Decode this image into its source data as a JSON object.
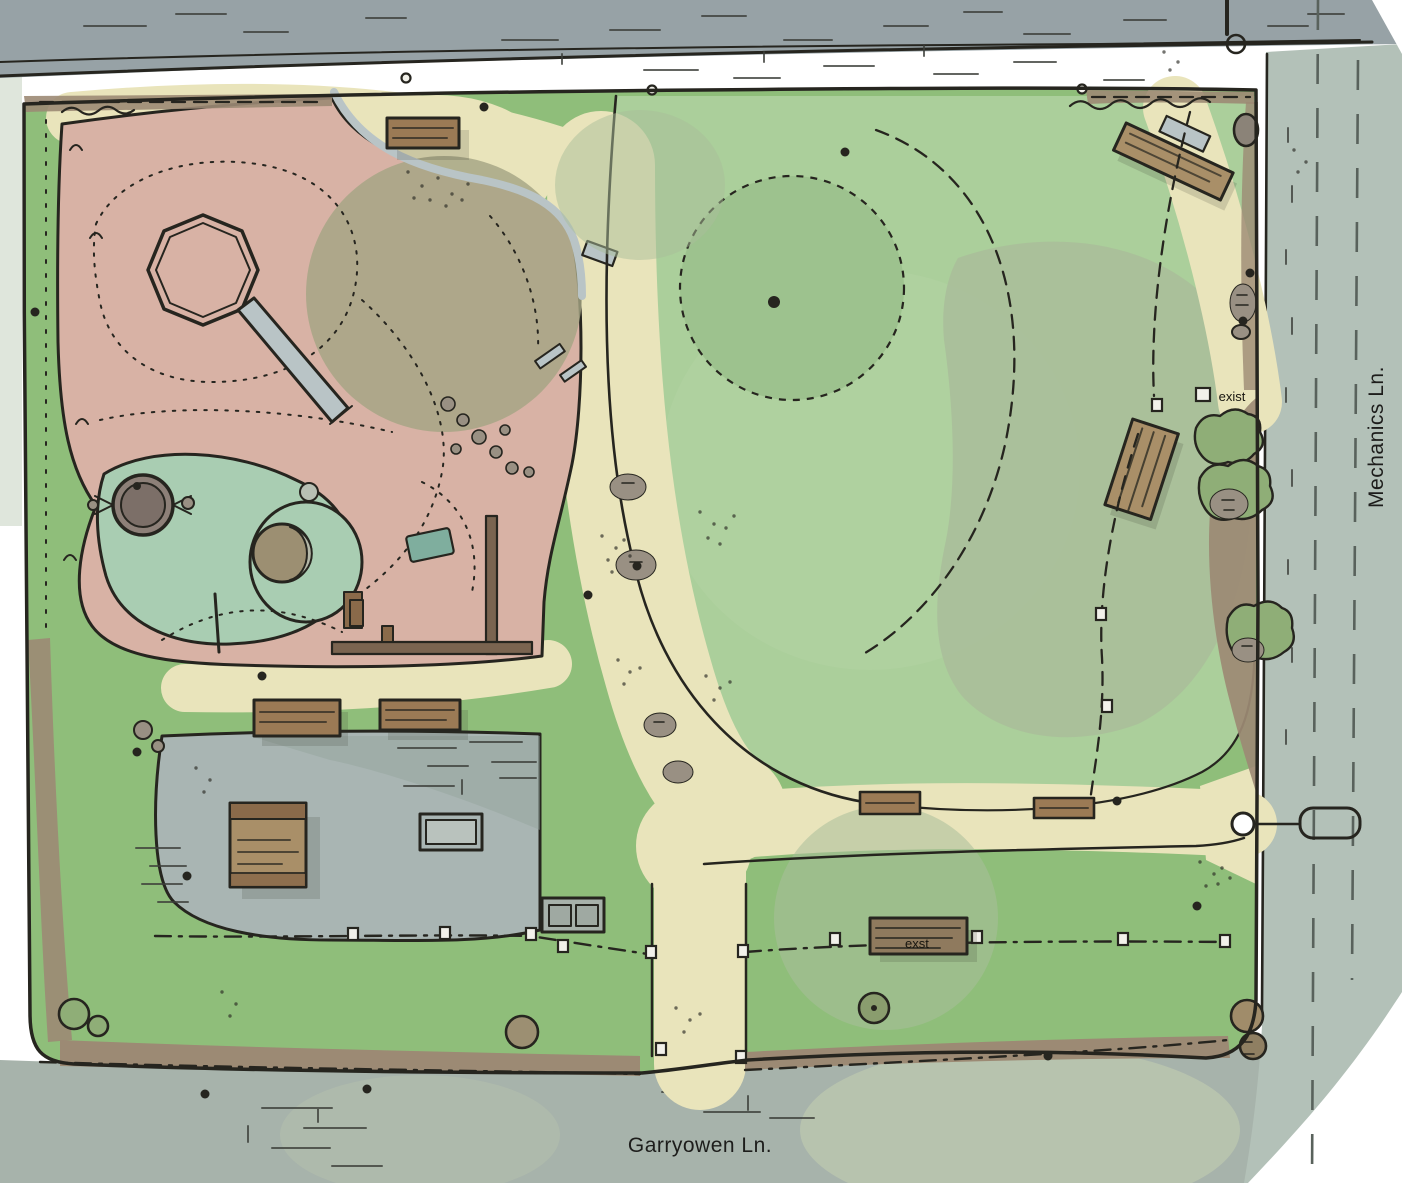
{
  "labels": {
    "street_right": "Mechanics Ln.",
    "street_bottom": "Garryowen Ln.",
    "existing_gate_note": "exist",
    "existing_bench_note": "exst"
  },
  "palette": {
    "paper": "#ffffff",
    "margin": "#dfe6dc",
    "ink": "#26251f",
    "streetTop": "#97a2a6",
    "streetRight": "#b3c1b8",
    "streetBottom": "#a7b3ab",
    "streetPatch": "#b9c4ae",
    "lawn": "#8fbe7a",
    "lawnLight": "#abcf9b",
    "moundCore": "#b3d4a3",
    "canopy": "#9dc28e",
    "canopySage": "#a9bd9a",
    "canopyOlive": "#a5a584",
    "playground": "#d8b2a5",
    "mint": "#a9cdb2",
    "path": "#e9e4bb",
    "plaza": "#a9b5b3",
    "plazaShade": "#93a49c",
    "mulch": "#9c8a74",
    "wood": "#9b7a55",
    "woodDark": "#8a6a4a",
    "woodLight": "#a98f68",
    "boulder": "#999083",
    "rockDark": "#8b8378",
    "steel": "#b9c4c6",
    "teal": "#7fae9e",
    "wall": "#7a6450",
    "crescent": "#b5b8a8",
    "grayDisc": "#b8c0b4",
    "spinnerRim": "#8d8078",
    "spinnerTop": "#7c6f68",
    "benchInner": "#b9c2bd",
    "benchPair": "#a7b1aa",
    "benchPairIn": "#9fa9a2",
    "bushGreen": "#8fae77",
    "bushKhaki": "#9c8f72",
    "bushSage": "#8a9d6e",
    "bushBrown": "#a08c6a",
    "bushBrownD": "#8f7f62",
    "exstWood": "#8f7a5e"
  }
}
